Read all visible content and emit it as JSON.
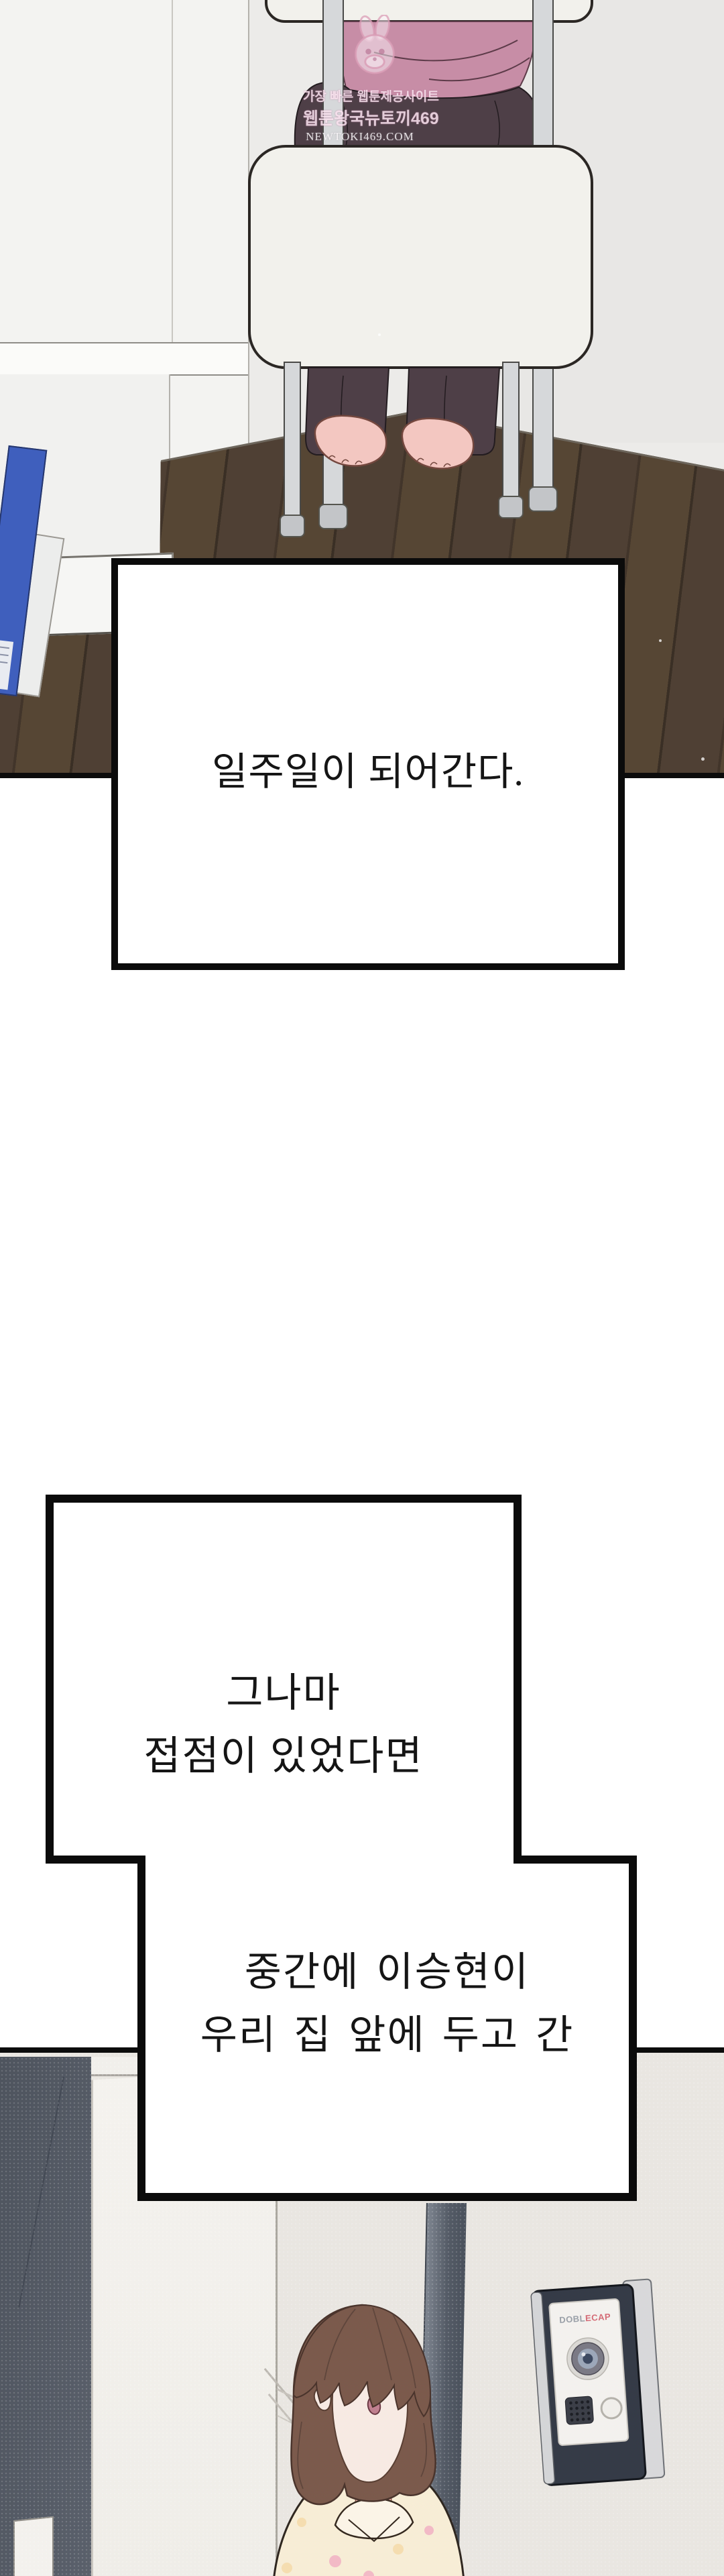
{
  "watermark": {
    "line1": "가장 빠른 웹툰제공사이트",
    "line2": "웹툰왕국뉴토끼469",
    "line3": "NEWTOKI469.COM",
    "mascot": "rabbit-mascot"
  },
  "narration": {
    "box1": {
      "text": "일주일이 되어간다."
    },
    "box2": {
      "line1": "그나마",
      "line2": "접점이 있었다면"
    },
    "box3": {
      "line1": "중간에 이승현이",
      "line2": "우리 집 앞에 두고 간"
    }
  },
  "intercom": {
    "brand_gray": "DOBL",
    "brand_red": "ECAP"
  },
  "colors": {
    "panel_border": "#0b0b0b",
    "page_background": "#ffffff",
    "top_wall": "#ecebe9",
    "wood_floor": "#4a3b30",
    "pink_top": "#c78da6",
    "pants": "#4e3f47",
    "chair_cushion": "#f2f1ec",
    "chair_metal": "#d6d8da",
    "blue_book": "#3f5fbd",
    "hair": "#7b5a4c",
    "skin": "#f7eae3",
    "shirt": "#f7edd6",
    "polka_dot_pink": "#f2bac6",
    "polka_dot_peach": "#f5ddb0",
    "door_dark_band": "#545b66",
    "entry_wall": "#e9e6e1",
    "intercom_body": "#353b47"
  }
}
